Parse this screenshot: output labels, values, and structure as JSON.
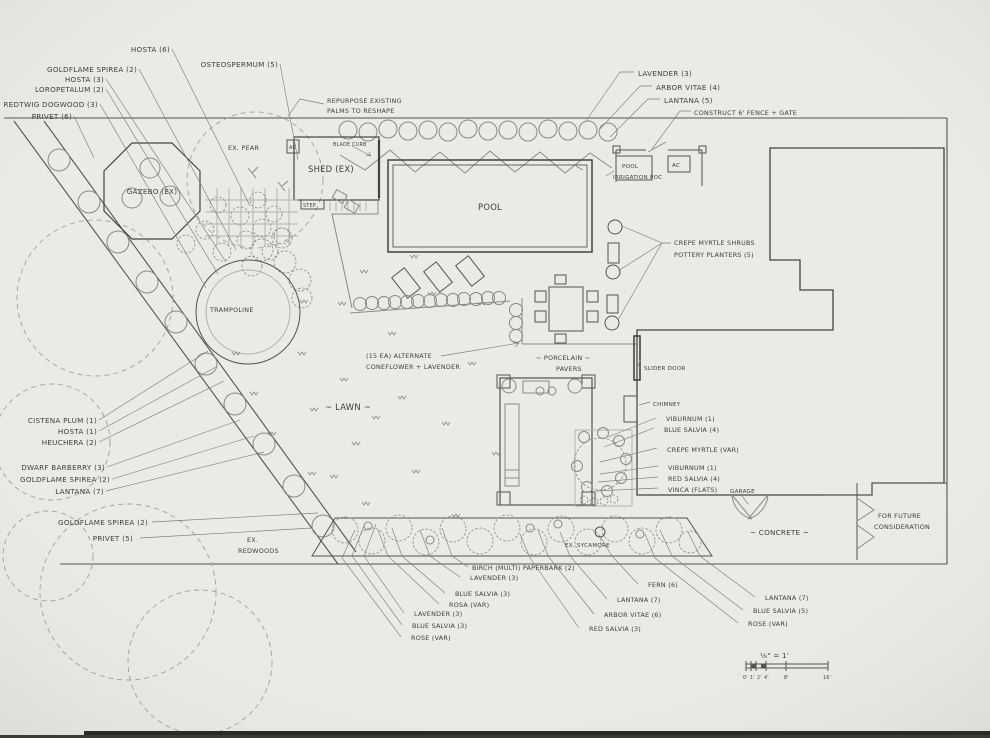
{
  "drawing_type": "hand-drawn residential landscape design plan",
  "labels": {
    "hosta_6": "HOSTA (6)",
    "osteospermum": "OSTEOSPERMUM (5)",
    "goldflame_spirea_a": "GOLDFLAME SPIREA (2)",
    "hosta_3": "HOSTA (3)",
    "loropetalum": "LOROPETALUM (2)",
    "redtwig_dogwood": "REDTWIG DOGWOOD (3)",
    "privet_6": "PRIVET (6)",
    "repurpose_1": "REPURPOSE EXISTING",
    "repurpose_2": "PALMS TO RESHAPE",
    "blade_curb": "BLADE CURB",
    "shed": "SHED (EX)",
    "step": "STEP",
    "ac_small": "AC",
    "pool": "POOL",
    "lavender_tr": "LAVENDER (3)",
    "arbor_vitae_tr": "ARBOR VITAE (4)",
    "lantana_tr": "LANTANA (5)",
    "construct_fence": "CONSTRUCT 6' FENCE + GATE",
    "pool_equip": "POOL",
    "ac_equip": "AC",
    "irrigation": "IRRIGATION POC",
    "crepe_shelf_1": "CREPE MYRTLE SHRUBS",
    "crepe_shelf_2": "POTTERY PLANTERS (5)",
    "gazebo": "GAZEBO (EX)",
    "ex_pear": "EX. PEAR",
    "trampoline": "TRAMPOLINE",
    "lawn": "~ LAWN ~",
    "alt_1": "(15 EA) ALTERNATE",
    "alt_2": "CONEFLOWER + LAVENDER",
    "porcelain_1": "~ PORCELAIN ~",
    "porcelain_2": "PAVERS",
    "slider_door": "SLIDER DOOR",
    "chimney": "CHIMNEY",
    "viburnum_a": "VIBURNUM (1)",
    "blue_salvia_4": "BLUE SALVIA (4)",
    "crepe_var": "CREPE MYRTLE (VAR)",
    "viburnum_b": "VIBURNUM (1)",
    "red_salvia_4": "RED SALVIA (4)",
    "vinca": "VINCA (FLATS)",
    "garage": "GARAGE",
    "concrete": "~ CONCRETE ~",
    "future_1": "FOR FUTURE",
    "future_2": "CONSIDERATION",
    "cistena": "CISTENA PLUM (1)",
    "hosta_1": "HOSTA (1)",
    "heuchera": "HEUCHERA (2)",
    "dwarf_barberry": "DWARF BARBERRY (3)",
    "goldflame_spirea_b": "GOLDFLAME SPIREA (2)",
    "lantana_7a": "LANTANA (7)",
    "goldflame_spirea_c": "GOLDFLAME SPIREA (2)",
    "privet_5": "PRIVET (5)",
    "ex_redwoods_1": "EX.",
    "ex_redwoods_2": "REDWOODS",
    "birch": "BIRCH (MULTI) PAPERBARK (2)",
    "lavender_b1": "LAVENDER (3)",
    "blue_salvia_b1": "BLUE SALVIA (3)",
    "rosa_var": "ROSA (VAR)",
    "lavender_b2": "LAVENDER (3)",
    "blue_salvia_b2": "BLUE SALVIA (3)",
    "rose_var_a": "ROSE (VAR)",
    "fern": "FERN (6)",
    "lantana_7b": "LANTANA (7)",
    "arbor_vitae_6": "ARBOR VITAE (6)",
    "red_salvia_3": "RED SALVIA (3)",
    "lantana_7c": "LANTANA (7)",
    "blue_salvia_5": "BLUE SALVIA (5)",
    "rose_var_b": "ROSE (VAR)",
    "ex_sycamore": "EX. SYCAMORE"
  },
  "scale": {
    "text": "⅛\" = 1'",
    "ticks": [
      "0'",
      "1'",
      "2'",
      "4'",
      "8'",
      "16'"
    ]
  }
}
